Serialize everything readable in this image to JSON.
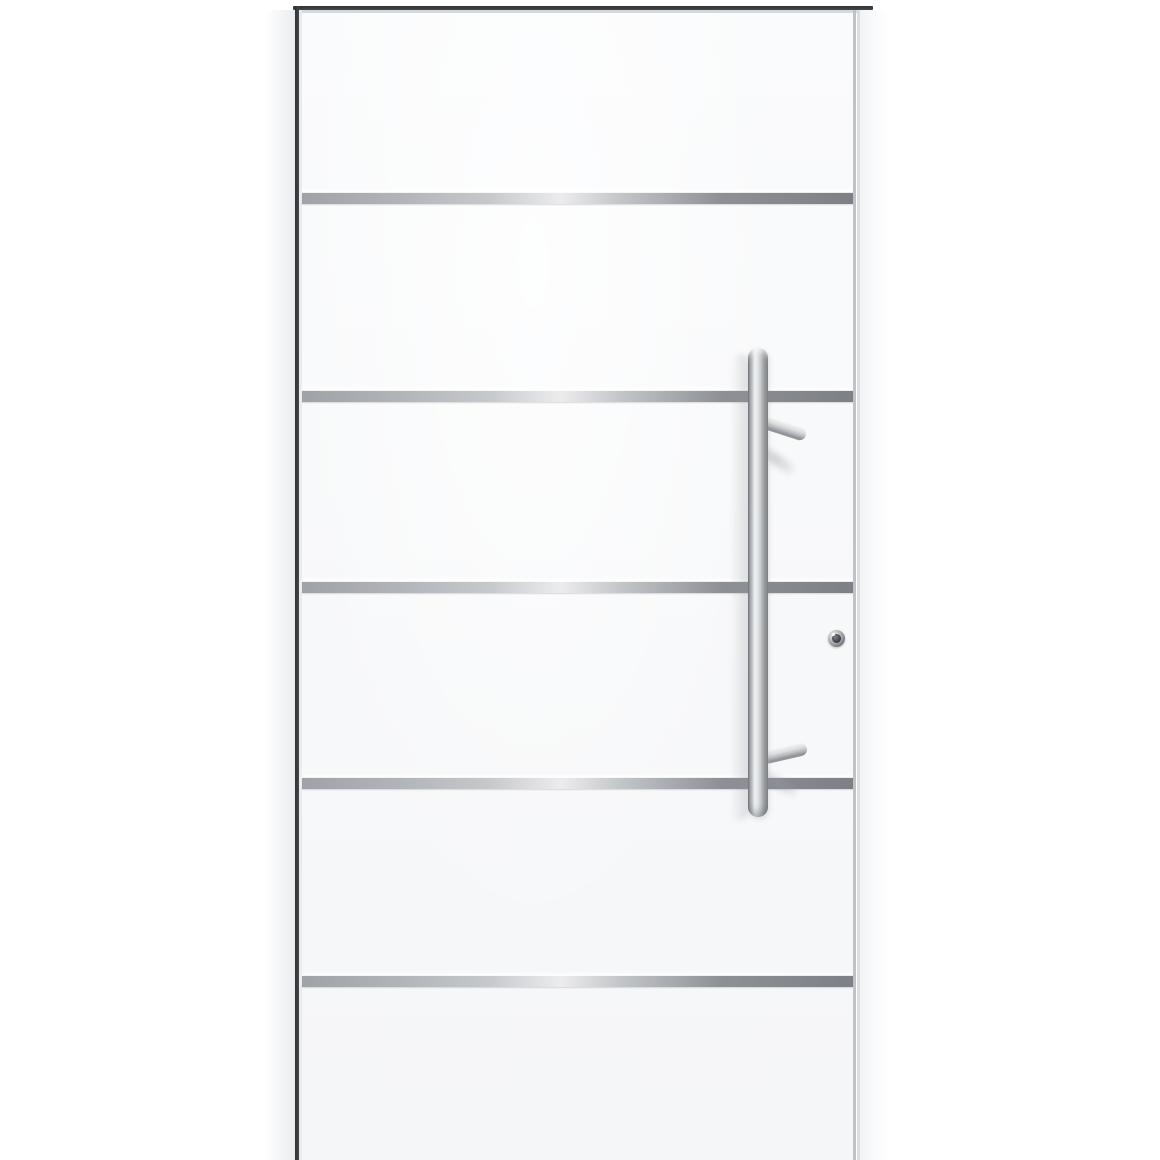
{
  "meta": {
    "domain": "Natural-Image",
    "subject": "Product photo: white aluminium front entry door with five horizontal stainless-steel inlay stripes, vertical stainless-steel bar pull handle with two mounts, and profile lock cylinder, on a plain white background"
  },
  "colors": {
    "bg": "#ffffff",
    "leaf-top": "#fafbfc",
    "leaf-bottom": "#f5f6f8",
    "frame-dark": "#43474b",
    "frame-light": "#d6d9dc",
    "gap-line": "#bfc3c7",
    "gap-line-light": "#dcdfe2",
    "stripe-a": "#9fa3a8",
    "stripe-b": "#c6c9cc",
    "stripe-hi": "#ececee",
    "stripe-c": "#8d9196",
    "stripe-d": "#7d8187",
    "steel-edge": "#63676b",
    "steel-light": "#eef0f1",
    "steel-mid": "#c9ccce",
    "steel-dark": "#85898d",
    "lock-core": "#3e4246"
  },
  "geometry": {
    "canvas": {
      "left": 0,
      "top": 0,
      "width": 1160,
      "height": 1160
    },
    "outer_shadow_left": {
      "left": 266,
      "top": 10,
      "width": 29,
      "height": 1150
    },
    "frame_top_dark": {
      "left": 293,
      "top": 6,
      "width": 580,
      "height": 4
    },
    "frame_top_light": {
      "left": 300,
      "top": 10,
      "width": 566,
      "height": 3
    },
    "frame_left_dark": {
      "left": 295,
      "top": 6,
      "width": 4,
      "height": 1154
    },
    "frame_left_light": {
      "left": 299,
      "top": 10,
      "width": 3,
      "height": 1150
    },
    "leaf": {
      "left": 302,
      "top": 10,
      "width": 551,
      "height": 1150
    },
    "leaf_sheen": {
      "left": 302,
      "top": 10,
      "width": 551,
      "height": 1150
    },
    "leaf_gap": {
      "left": 853,
      "top": 10,
      "width": 3,
      "height": 1150
    },
    "leaf_gap_light": {
      "left": 857,
      "top": 10,
      "width": 3,
      "height": 1150
    },
    "frame_right_face": {
      "left": 860,
      "top": 10,
      "width": 30,
      "height": 1150
    },
    "stripes": {
      "height": 11,
      "centers_y": [
        197,
        395,
        586,
        782,
        980
      ]
    },
    "bar_shadow": {
      "left": 731,
      "top": 354,
      "width": 18,
      "height": 466
    },
    "arm_top_shadow": {
      "left": 752,
      "top": 438,
      "width": 50,
      "height": 11,
      "rotate": 34
    },
    "arm_bottom_shadow": {
      "left": 754,
      "top": 766,
      "width": 48,
      "height": 11,
      "rotate": 26
    },
    "arm_top": {
      "left": 762,
      "top": 415,
      "width": 46,
      "height": 13,
      "rotate": 18
    },
    "arm_bottom": {
      "left": 762,
      "top": 752,
      "width": 46,
      "height": 13,
      "rotate": -13
    },
    "bar": {
      "left": 748,
      "top": 348,
      "width": 20,
      "height": 469
    },
    "lock": {
      "left": 828,
      "top": 630,
      "width": 17,
      "height": 17
    }
  }
}
